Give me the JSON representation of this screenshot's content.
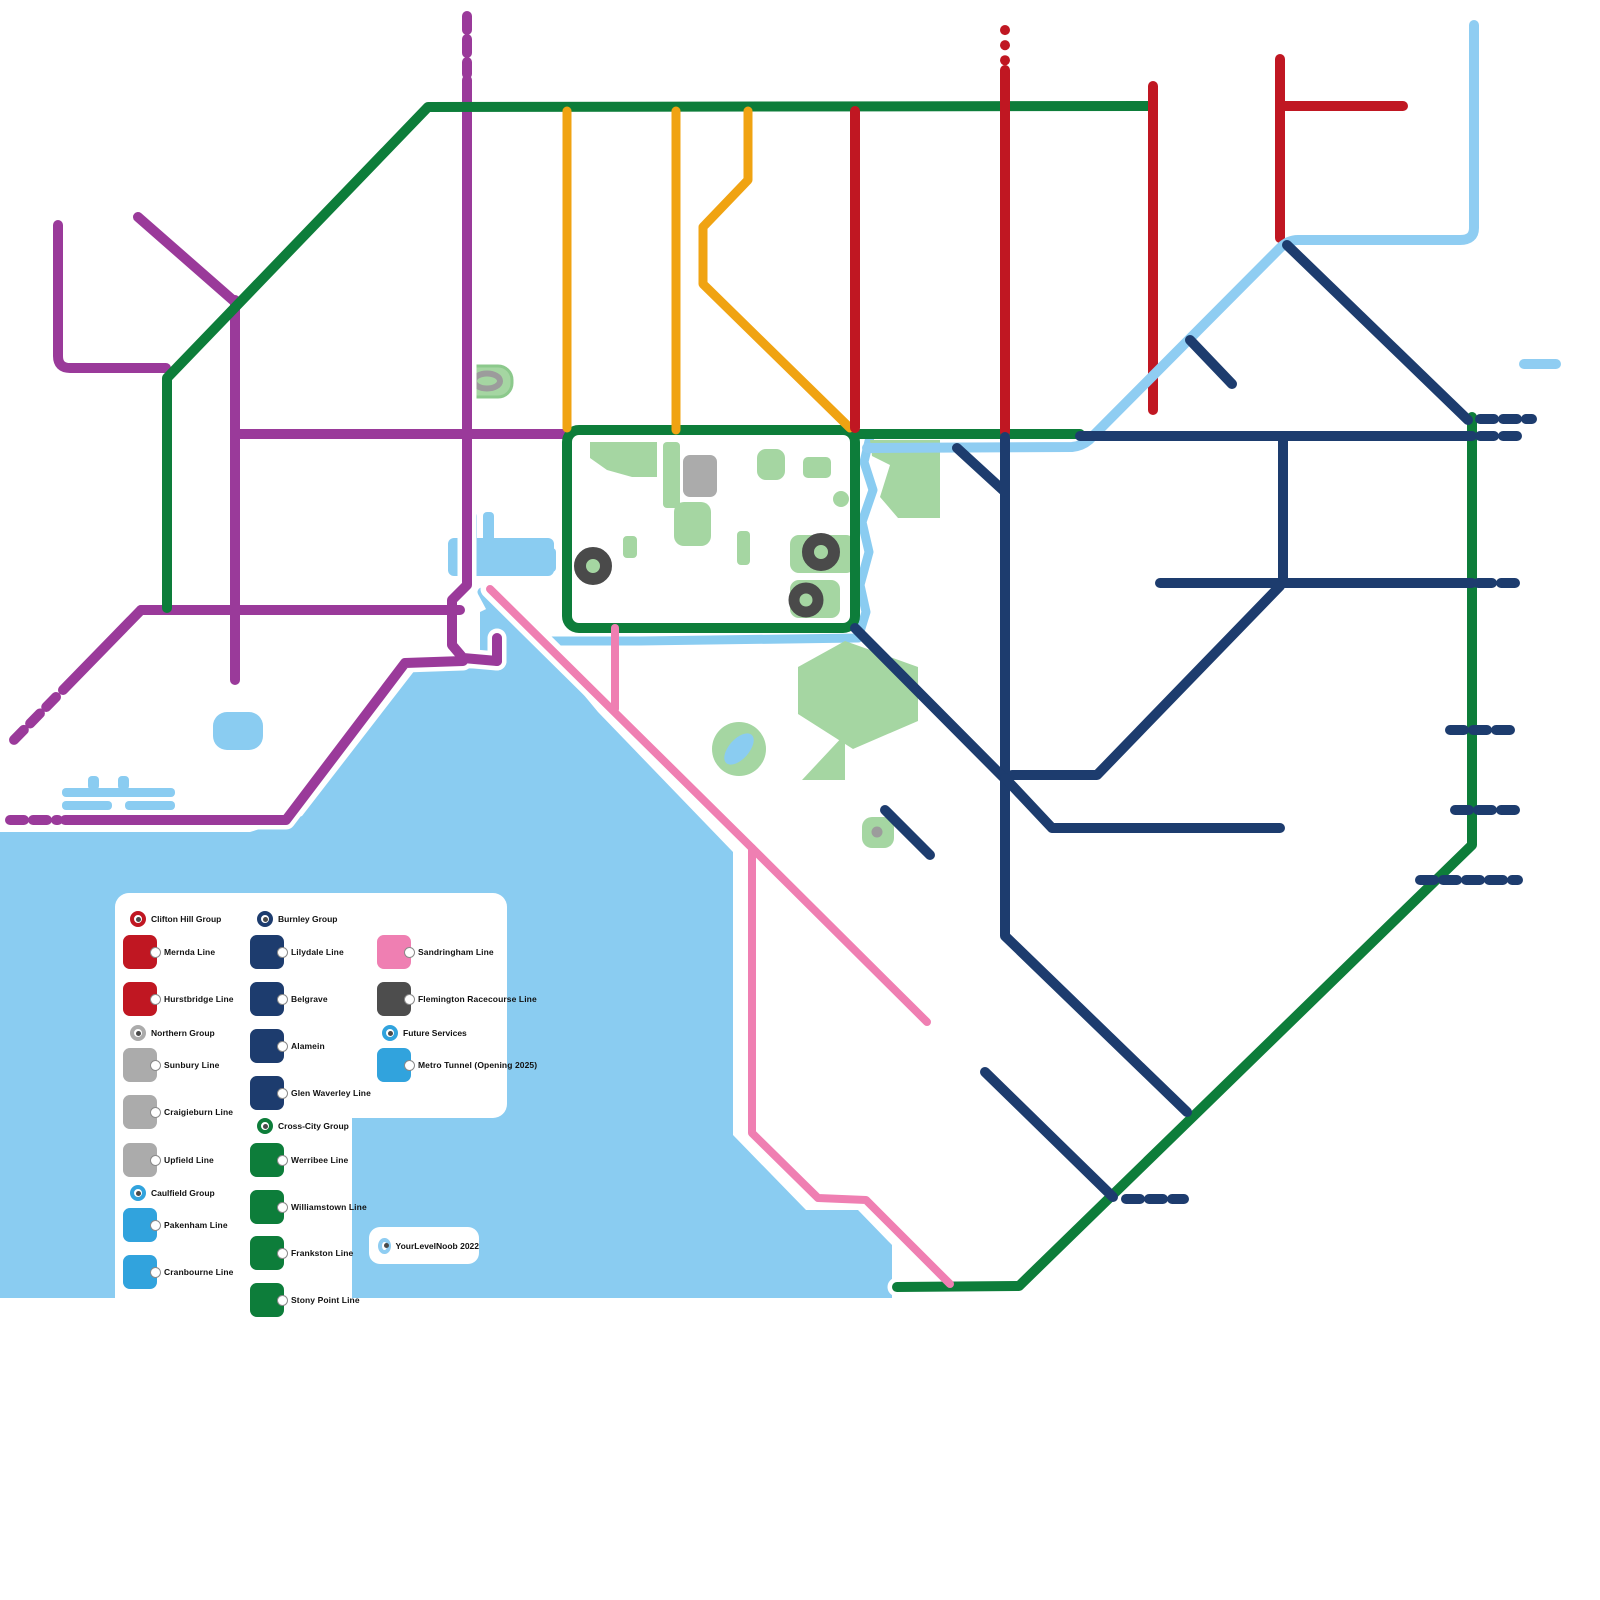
{
  "colors": {
    "red": "#c01722",
    "purple": "#9a3a9a",
    "yellow": "#f0a312",
    "green": "#0d7d3a",
    "navy": "#1d3c6e",
    "skyline": "#8fcdf2",
    "skybox": "#31a3dd",
    "pink": "#ef7fb2",
    "water": "#8accf1",
    "park": "#a5d6a2",
    "gray": "#ababab",
    "darkgray": "#4d4d4d"
  },
  "legend": {
    "clifton_group": "Clifton Hill Group",
    "mernda": "Mernda Line",
    "hurstbridge": "Hurstbridge Line",
    "northern_group": "Northern Group",
    "sunbury": "Sunbury Line",
    "craigieburn": "Craigieburn Line",
    "upfield": "Upfield Line",
    "caulfield_group": "Caulfield Group",
    "pakenham": "Pakenham Line",
    "cranbourne": "Cranbourne Line",
    "burnley_group": "Burnley Group",
    "lilydale": "Lilydale Line",
    "belgrave": "Belgrave",
    "alamein": "Alamein",
    "glen_waverley": "Glen Waverley Line",
    "crosscity_group": "Cross-City Group",
    "werribee": "Werribee Line",
    "williamstown": "Williamstown Line",
    "frankston": "Frankston Line",
    "stony_point": "Stony Point Line",
    "sandringham": "Sandringham Line",
    "flemington": "Flemington Racecourse Line",
    "future_group": "Future Services",
    "metro_tunnel": "Metro Tunnel (Opening 2025)"
  },
  "watermark": {
    "label": "YourLevelNoob 2022"
  },
  "icons": {
    "group_marker": "ring-icon",
    "station_marker": "station-dot-icon",
    "stadium_marker": "stadium-ring-icon",
    "racecourse_marker": "racecourse-oval-icon"
  }
}
